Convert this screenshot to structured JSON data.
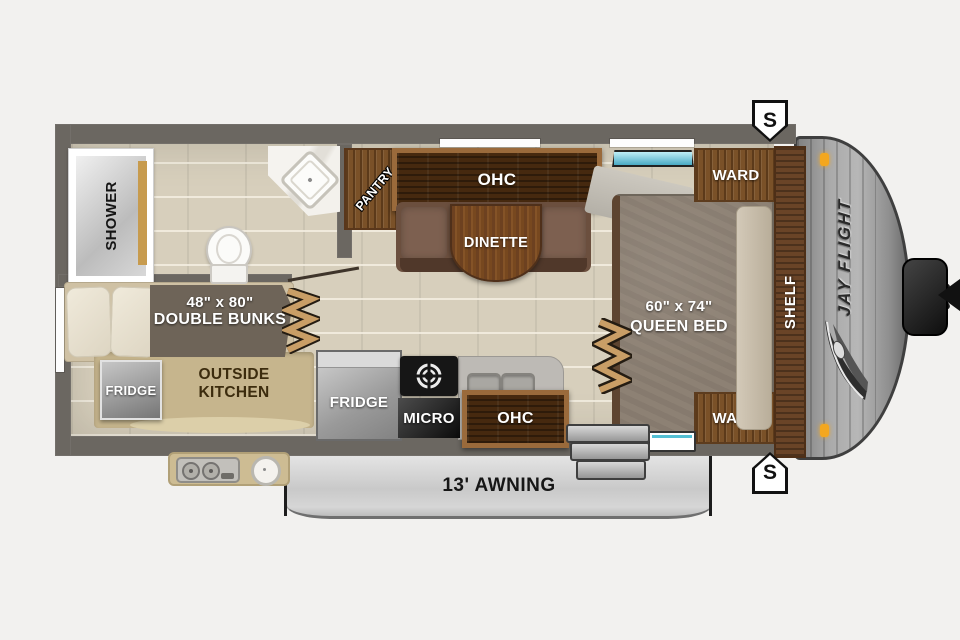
{
  "colors": {
    "wall": "#6b6761",
    "floor_tile": "#d7cfbc",
    "wood_dark": "#46290f",
    "wood_mid": "#7a5128",
    "counter_tan": "#c6b58d",
    "clearance_light_orange": "#f3a71f",
    "window_blue": "#49aac4",
    "awning_gray": "#c9c9c9"
  },
  "icons": [
    "toilet-icon",
    "corner-sink-icon",
    "stove-burner-icon",
    "double-sink-icon",
    "outdoor-stove-icon",
    "outdoor-sink-icon",
    "bunk-ladder-icon",
    "bed-steps-icon",
    "entry-steps-icon",
    "wing-logo-icon",
    "clearance-light-icon",
    "propane-tank-icon",
    "hitch-icon",
    "window-icon",
    "entry-door-icon"
  ],
  "interior": {
    "bathroom": {
      "shower": "SHOWER"
    },
    "dinette_area": {
      "pantry": "PANTRY",
      "ohc": "OHC",
      "dinette": "DINETTE"
    },
    "bedroom": {
      "ward_top": "WARD",
      "ward_bottom": "WARD",
      "shelf": "SHELF",
      "bed_size": "60\" x 74\"",
      "bed_name": "QUEEN BED"
    },
    "bunk_room": {
      "bunk_size": "48\" x 80\"",
      "bunk_name": "DOUBLE BUNKS",
      "fridge": "FRIDGE",
      "outside_kitchen_line1": "OUTSIDE",
      "outside_kitchen_line2": "KITCHEN"
    },
    "kitchen": {
      "fridge": "FRIDGE",
      "micro": "MICRO",
      "ohc": "OHC"
    }
  },
  "exterior": {
    "brand": "JAY FLIGHT",
    "awning": "13' AWNING",
    "stabilizer_top": "S",
    "stabilizer_bottom": "S"
  }
}
